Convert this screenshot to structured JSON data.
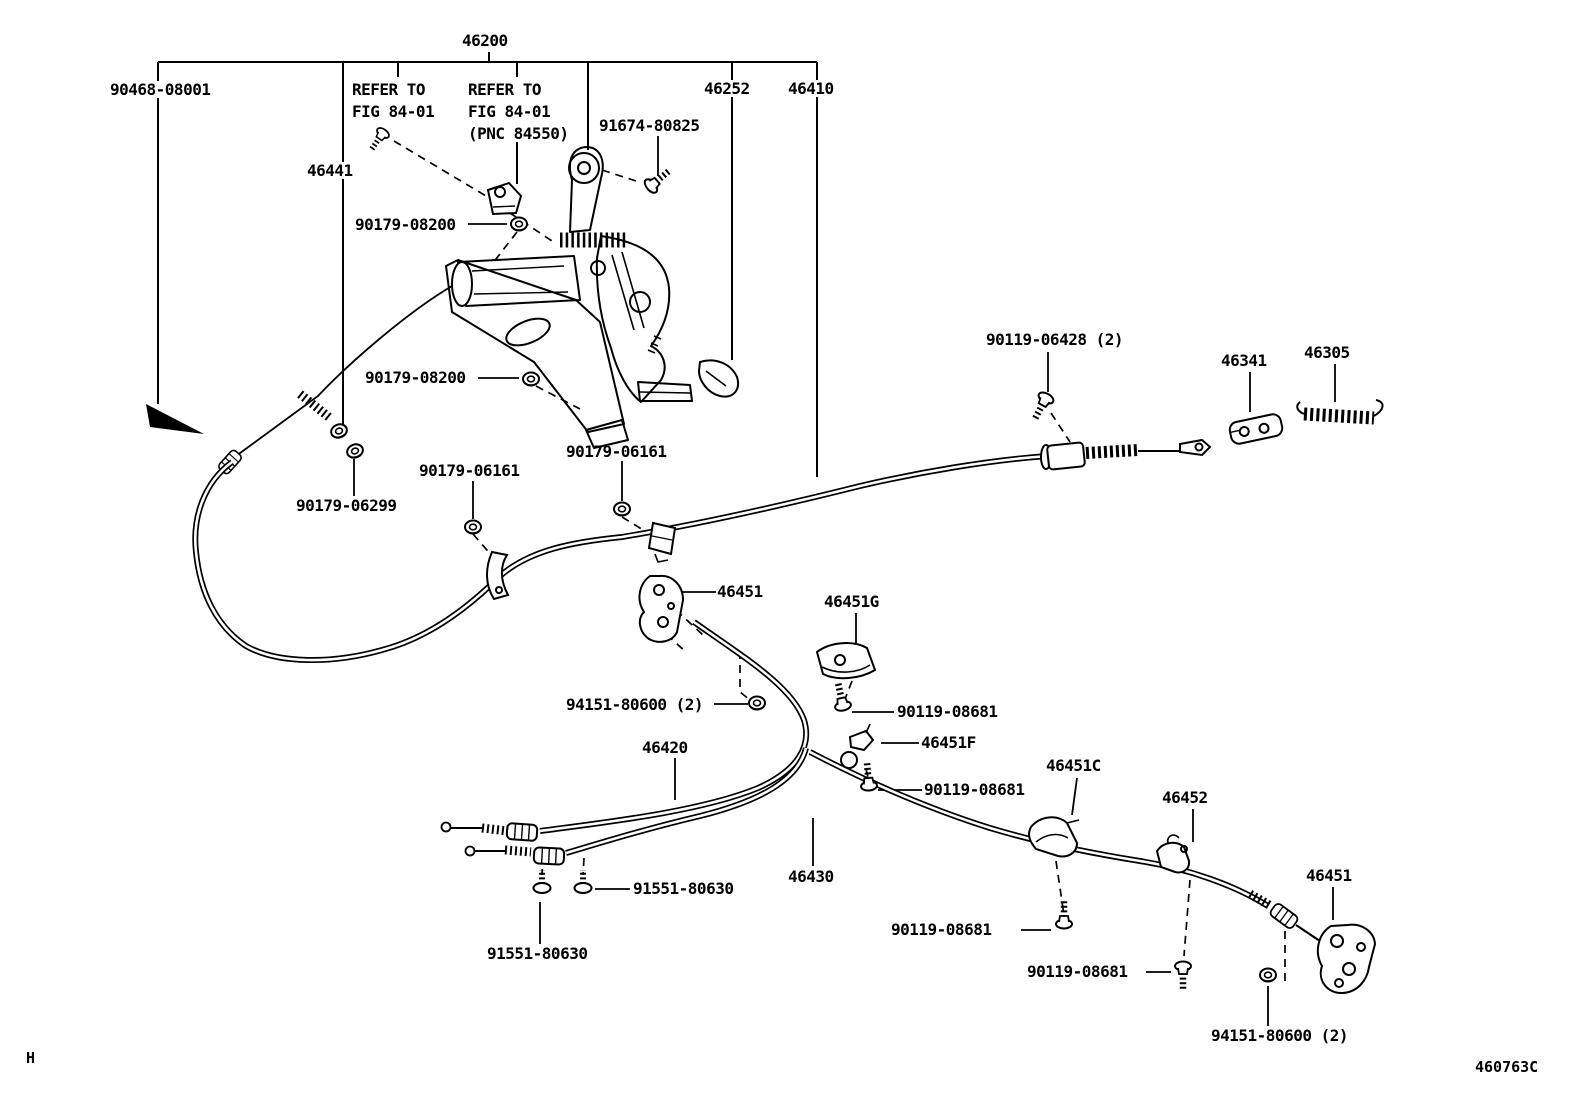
{
  "diagram": {
    "figure_code": "460763C",
    "corner_mark": "H",
    "root_label": "46200",
    "notes": {
      "refer1_l1": "REFER TO",
      "refer1_l2": "FIG 84-01",
      "refer2_l1": "REFER TO",
      "refer2_l2": "FIG 84-01",
      "refer2_l3": "(PNC 84550)"
    },
    "labels": {
      "l90468_08001": "90468-08001",
      "l46252": "46252",
      "l46410": "46410",
      "l46441": "46441",
      "l91674_80825": "91674-80825",
      "l90179_08200_a": "90179-08200",
      "l90179_08200_b": "90179-08200",
      "l90179_06299": "90179-06299",
      "l90179_06161_a": "90179-06161",
      "l90179_06161_b": "90179-06161",
      "l90119_06428": "90119-06428 (2)",
      "l46341": "46341",
      "l46305": "46305",
      "l46451_a": "46451",
      "l46451g": "46451G",
      "l94151_80600_a": "94151-80600 (2)",
      "l90119_08681_a": "90119-08681",
      "l46451f": "46451F",
      "l46420": "46420",
      "l90119_08681_b": "90119-08681",
      "l46451c": "46451C",
      "l46452": "46452",
      "l46430": "46430",
      "l91551_80630_a": "91551-80630",
      "l91551_80630_b": "91551-80630",
      "l90119_08681_c": "90119-08681",
      "l90119_08681_d": "90119-08681",
      "l46451_b": "46451",
      "l94151_80600_b": "94151-80600 (2)"
    },
    "ink_color": "#000000",
    "background_color": "#ffffff"
  }
}
